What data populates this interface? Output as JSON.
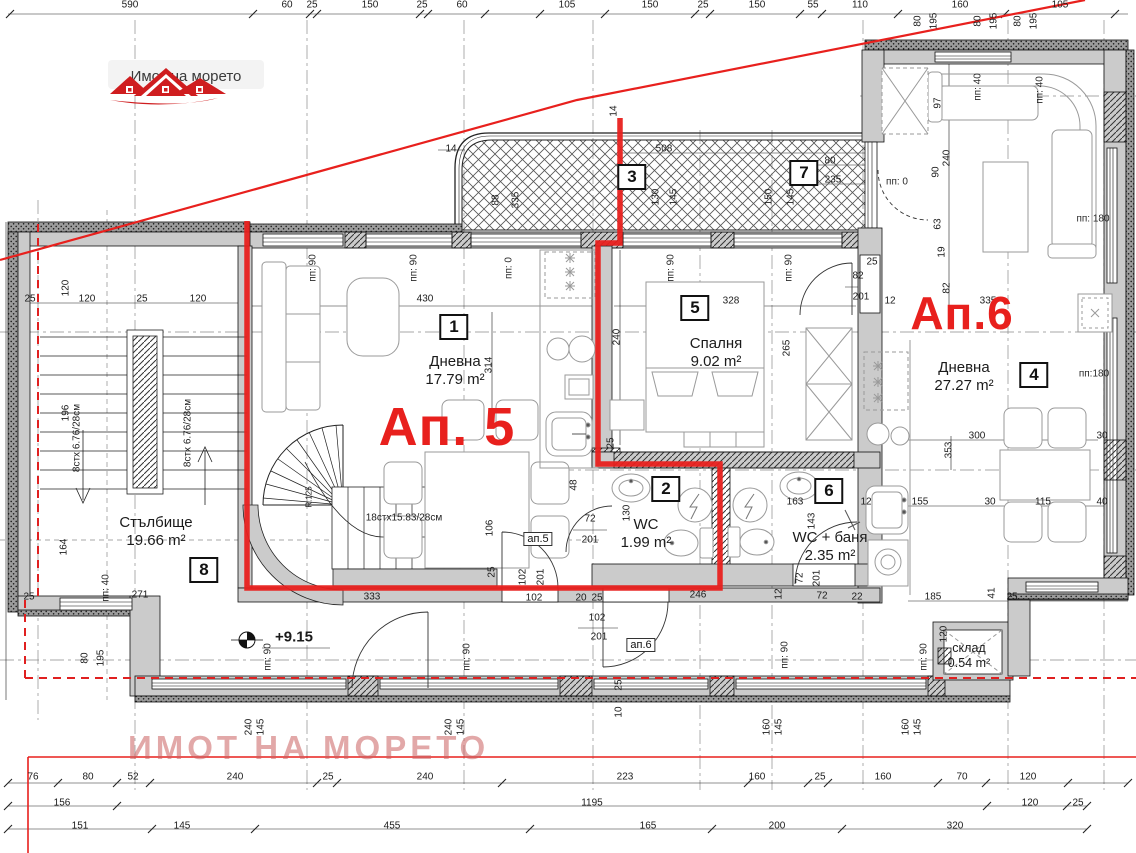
{
  "logo": {
    "text": "Имот на морето",
    "icon": "red-houses-icon"
  },
  "watermark": {
    "text": "ИМОТ НА МОРЕТО"
  },
  "colors": {
    "red": "#e8201d",
    "wall_gray": "#cbcbcb",
    "logo_red": "#cf1d1f"
  },
  "apartments": [
    {
      "t": "Ап. 5",
      "x": 447,
      "y": 427,
      "fs": 54
    },
    {
      "t": "Ап.6",
      "x": 962,
      "y": 313,
      "fs": 46
    }
  ],
  "rooms": [
    {
      "no": "1",
      "name": "Дневна",
      "area": "17.79 m²",
      "lx": 455,
      "ly": 371,
      "bx": 454,
      "by": 327
    },
    {
      "no": "5",
      "name": "Спалня",
      "area": "9.02 m²",
      "lx": 716,
      "ly": 353,
      "bx": 695,
      "by": 308
    },
    {
      "no": "4",
      "name": "Дневна",
      "area": "27.27 m²",
      "lx": 964,
      "ly": 377,
      "bx": 1034,
      "by": 375
    },
    {
      "no": "8",
      "name": "Стълбище",
      "area": "19.66 m²",
      "lx": 156,
      "ly": 532,
      "bx": 204,
      "by": 570
    },
    {
      "no": "2",
      "name": "WC",
      "area": "1.99 m²",
      "lx": 646,
      "ly": 534,
      "bx": 666,
      "by": 489
    },
    {
      "no": "6",
      "name": "WC + баня",
      "area": "2.35 m²",
      "lx": 830,
      "ly": 547,
      "bx": 829,
      "by": 491
    },
    {
      "no": "3",
      "bx": 632,
      "by": 177
    },
    {
      "no": "7",
      "bx": 804,
      "by": 173
    },
    {
      "name": "склад",
      "area": "0.54 m²",
      "lx": 969,
      "ly": 656,
      "small": true
    }
  ],
  "door_tags": [
    {
      "t": "ап.5",
      "x": 538,
      "y": 539
    },
    {
      "t": "ап.6",
      "x": 641,
      "y": 645
    }
  ],
  "level_mark": {
    "text": "+9.15",
    "x": 294,
    "y": 637
  },
  "stair_notes": [
    {
      "t": "8стх 6.76/28см",
      "x": 77,
      "y": 438,
      "r": 1
    },
    {
      "t": "8стх 6.76/28см",
      "x": 188,
      "y": 433,
      "r": 1
    },
    {
      "t": "18стх15.83/28см",
      "x": 404,
      "y": 518
    },
    {
      "t": "R.125",
      "x": 309,
      "y": 497,
      "r": 1,
      "fs": 8
    }
  ],
  "window_labels": [
    {
      "t": "пп: 90",
      "x": 313,
      "y": 268,
      "r": 1
    },
    {
      "t": "пп: 90",
      "x": 414,
      "y": 268,
      "r": 1
    },
    {
      "t": "пп: 0",
      "x": 509,
      "y": 268,
      "r": 1
    },
    {
      "t": "пп: 90",
      "x": 671,
      "y": 268,
      "r": 1
    },
    {
      "t": "пп: 90",
      "x": 789,
      "y": 268,
      "r": 1
    },
    {
      "t": "пп: 0",
      "x": 897,
      "y": 182
    },
    {
      "t": "пп: 40",
      "x": 978,
      "y": 87,
      "r": 1
    },
    {
      "t": "пп: 40",
      "x": 1040,
      "y": 90,
      "r": 1
    },
    {
      "t": "пп: 180",
      "x": 1093,
      "y": 219
    },
    {
      "t": "пп:180",
      "x": 1094,
      "y": 374
    },
    {
      "t": "пп: 40",
      "x": 106,
      "y": 588,
      "r": 1
    },
    {
      "t": "пп: 90",
      "x": 268,
      "y": 657,
      "r": 1
    },
    {
      "t": "пп: 90",
      "x": 467,
      "y": 657,
      "r": 1
    },
    {
      "t": "пп: 90",
      "x": 785,
      "y": 655,
      "r": 1
    },
    {
      "t": "пп: 90",
      "x": 924,
      "y": 657,
      "r": 1
    }
  ],
  "dimensions": [
    {
      "t": "590",
      "x": 130,
      "y": 5
    },
    {
      "t": "60",
      "x": 287,
      "y": 5
    },
    {
      "t": "25",
      "x": 312,
      "y": 5
    },
    {
      "t": "150",
      "x": 370,
      "y": 5
    },
    {
      "t": "25",
      "x": 422,
      "y": 5
    },
    {
      "t": "60",
      "x": 462,
      "y": 5
    },
    {
      "t": "105",
      "x": 567,
      "y": 5
    },
    {
      "t": "150",
      "x": 650,
      "y": 5
    },
    {
      "t": "25",
      "x": 703,
      "y": 5
    },
    {
      "t": "150",
      "x": 757,
      "y": 5
    },
    {
      "t": "55",
      "x": 813,
      "y": 5
    },
    {
      "t": "110",
      "x": 860,
      "y": 5
    },
    {
      "t": "160",
      "x": 960,
      "y": 5
    },
    {
      "t": "105",
      "x": 1060,
      "y": 5
    },
    {
      "t": "80",
      "x": 918,
      "y": 21,
      "r": 1
    },
    {
      "t": "195",
      "x": 934,
      "y": 21,
      "r": 1
    },
    {
      "t": "80",
      "x": 978,
      "y": 21,
      "r": 1
    },
    {
      "t": "195",
      "x": 994,
      "y": 21,
      "r": 1
    },
    {
      "t": "80",
      "x": 1018,
      "y": 21,
      "r": 1
    },
    {
      "t": "195",
      "x": 1034,
      "y": 21,
      "r": 1
    },
    {
      "t": "14",
      "x": 451,
      "y": 149
    },
    {
      "t": "14",
      "x": 614,
      "y": 111,
      "r": 1
    },
    {
      "t": "508",
      "x": 664,
      "y": 149
    },
    {
      "t": "88",
      "x": 496,
      "y": 200,
      "r": 1
    },
    {
      "t": "335",
      "x": 516,
      "y": 200,
      "r": 1
    },
    {
      "t": "130",
      "x": 656,
      "y": 197,
      "r": 1
    },
    {
      "t": "145",
      "x": 674,
      "y": 197,
      "r": 1
    },
    {
      "t": "150",
      "x": 769,
      "y": 197,
      "r": 1
    },
    {
      "t": "145",
      "x": 791,
      "y": 197,
      "r": 1
    },
    {
      "t": "80",
      "x": 830,
      "y": 161
    },
    {
      "t": "235",
      "x": 833,
      "y": 180
    },
    {
      "t": "25",
      "x": 30,
      "y": 299
    },
    {
      "t": "120",
      "x": 87,
      "y": 299
    },
    {
      "t": "25",
      "x": 142,
      "y": 299
    },
    {
      "t": "120",
      "x": 198,
      "y": 299
    },
    {
      "t": "120",
      "x": 66,
      "y": 288,
      "r": 1
    },
    {
      "t": "196",
      "x": 66,
      "y": 413,
      "r": 1
    },
    {
      "t": "164",
      "x": 64,
      "y": 547,
      "r": 1
    },
    {
      "t": "271",
      "x": 140,
      "y": 595
    },
    {
      "t": "25",
      "x": 29,
      "y": 597
    },
    {
      "t": "80",
      "x": 85,
      "y": 658,
      "r": 1
    },
    {
      "t": "195",
      "x": 101,
      "y": 658,
      "r": 1
    },
    {
      "t": "430",
      "x": 425,
      "y": 299
    },
    {
      "t": "314",
      "x": 489,
      "y": 365,
      "r": 1
    },
    {
      "t": "240",
      "x": 617,
      "y": 337,
      "r": 1
    },
    {
      "t": "48",
      "x": 574,
      "y": 485,
      "r": 1
    },
    {
      "t": "25",
      "x": 611,
      "y": 443,
      "r": 1
    },
    {
      "t": "106",
      "x": 490,
      "y": 528,
      "r": 1
    },
    {
      "t": "25",
      "x": 492,
      "y": 572,
      "r": 1
    },
    {
      "t": "333",
      "x": 372,
      "y": 597
    },
    {
      "t": "102",
      "x": 534,
      "y": 598
    },
    {
      "t": "20",
      "x": 581,
      "y": 598
    },
    {
      "t": "25",
      "x": 597,
      "y": 598
    },
    {
      "t": "102",
      "x": 523,
      "y": 577,
      "r": 1
    },
    {
      "t": "201",
      "x": 541,
      "y": 577,
      "r": 1
    },
    {
      "t": "72",
      "x": 590,
      "y": 519
    },
    {
      "t": "201",
      "x": 590,
      "y": 540
    },
    {
      "t": "130",
      "x": 627,
      "y": 513,
      "r": 1
    },
    {
      "t": "163",
      "x": 795,
      "y": 502
    },
    {
      "t": "143",
      "x": 812,
      "y": 521,
      "r": 1
    },
    {
      "t": "12",
      "x": 866,
      "y": 502
    },
    {
      "t": "72",
      "x": 800,
      "y": 578,
      "r": 1
    },
    {
      "t": "201",
      "x": 817,
      "y": 578,
      "r": 1
    },
    {
      "t": "246",
      "x": 698,
      "y": 595
    },
    {
      "t": "12",
      "x": 779,
      "y": 594,
      "r": 1
    },
    {
      "t": "72",
      "x": 822,
      "y": 596
    },
    {
      "t": "22",
      "x": 857,
      "y": 597
    },
    {
      "t": "328",
      "x": 731,
      "y": 301
    },
    {
      "t": "265",
      "x": 787,
      "y": 348,
      "r": 1
    },
    {
      "t": "25",
      "x": 872,
      "y": 262
    },
    {
      "t": "82",
      "x": 858,
      "y": 276
    },
    {
      "t": "201",
      "x": 861,
      "y": 297
    },
    {
      "t": "12",
      "x": 890,
      "y": 301
    },
    {
      "t": "97",
      "x": 938,
      "y": 103,
      "r": 1
    },
    {
      "t": "240",
      "x": 947,
      "y": 158,
      "r": 1
    },
    {
      "t": "90",
      "x": 936,
      "y": 172,
      "r": 1
    },
    {
      "t": "63",
      "x": 938,
      "y": 224,
      "r": 1
    },
    {
      "t": "19",
      "x": 942,
      "y": 252,
      "r": 1
    },
    {
      "t": "82",
      "x": 947,
      "y": 288,
      "r": 1
    },
    {
      "t": "335",
      "x": 988,
      "y": 301
    },
    {
      "t": "300",
      "x": 977,
      "y": 436
    },
    {
      "t": "353",
      "x": 949,
      "y": 450,
      "r": 1
    },
    {
      "t": "30",
      "x": 1102,
      "y": 436
    },
    {
      "t": "155",
      "x": 920,
      "y": 502
    },
    {
      "t": "30",
      "x": 990,
      "y": 502
    },
    {
      "t": "115",
      "x": 1043,
      "y": 502
    },
    {
      "t": "40",
      "x": 1102,
      "y": 502
    },
    {
      "t": "185",
      "x": 933,
      "y": 597
    },
    {
      "t": "41",
      "x": 992,
      "y": 593,
      "r": 1
    },
    {
      "t": "25",
      "x": 1012,
      "y": 597
    },
    {
      "t": "120",
      "x": 944,
      "y": 634,
      "r": 1
    },
    {
      "t": "102",
      "x": 597,
      "y": 618
    },
    {
      "t": "201",
      "x": 599,
      "y": 637
    },
    {
      "t": "25",
      "x": 619,
      "y": 685,
      "r": 1
    },
    {
      "t": "10",
      "x": 619,
      "y": 712,
      "r": 1
    },
    {
      "t": "240",
      "x": 249,
      "y": 727,
      "r": 1
    },
    {
      "t": "145",
      "x": 261,
      "y": 727,
      "r": 1
    },
    {
      "t": "240",
      "x": 449,
      "y": 727,
      "r": 1
    },
    {
      "t": "145",
      "x": 461,
      "y": 727,
      "r": 1
    },
    {
      "t": "160",
      "x": 767,
      "y": 727,
      "r": 1
    },
    {
      "t": "145",
      "x": 779,
      "y": 727,
      "r": 1
    },
    {
      "t": "160",
      "x": 906,
      "y": 727,
      "r": 1
    },
    {
      "t": "145",
      "x": 918,
      "y": 727,
      "r": 1
    },
    {
      "t": "76",
      "x": 33,
      "y": 777
    },
    {
      "t": "80",
      "x": 88,
      "y": 777
    },
    {
      "t": "52",
      "x": 133,
      "y": 777
    },
    {
      "t": "240",
      "x": 235,
      "y": 777
    },
    {
      "t": "25",
      "x": 328,
      "y": 777
    },
    {
      "t": "240",
      "x": 425,
      "y": 777
    },
    {
      "t": "223",
      "x": 625,
      "y": 777
    },
    {
      "t": "160",
      "x": 757,
      "y": 777
    },
    {
      "t": "25",
      "x": 820,
      "y": 777
    },
    {
      "t": "160",
      "x": 883,
      "y": 777
    },
    {
      "t": "70",
      "x": 962,
      "y": 777
    },
    {
      "t": "120",
      "x": 1028,
      "y": 777
    },
    {
      "t": "156",
      "x": 62,
      "y": 803
    },
    {
      "t": "1195",
      "x": 592,
      "y": 803
    },
    {
      "t": "120",
      "x": 1030,
      "y": 803
    },
    {
      "t": "25",
      "x": 1078,
      "y": 803
    },
    {
      "t": "151",
      "x": 80,
      "y": 826
    },
    {
      "t": "145",
      "x": 182,
      "y": 826
    },
    {
      "t": "455",
      "x": 392,
      "y": 826
    },
    {
      "t": "165",
      "x": 648,
      "y": 826
    },
    {
      "t": "200",
      "x": 777,
      "y": 826
    },
    {
      "t": "320",
      "x": 955,
      "y": 826
    }
  ]
}
